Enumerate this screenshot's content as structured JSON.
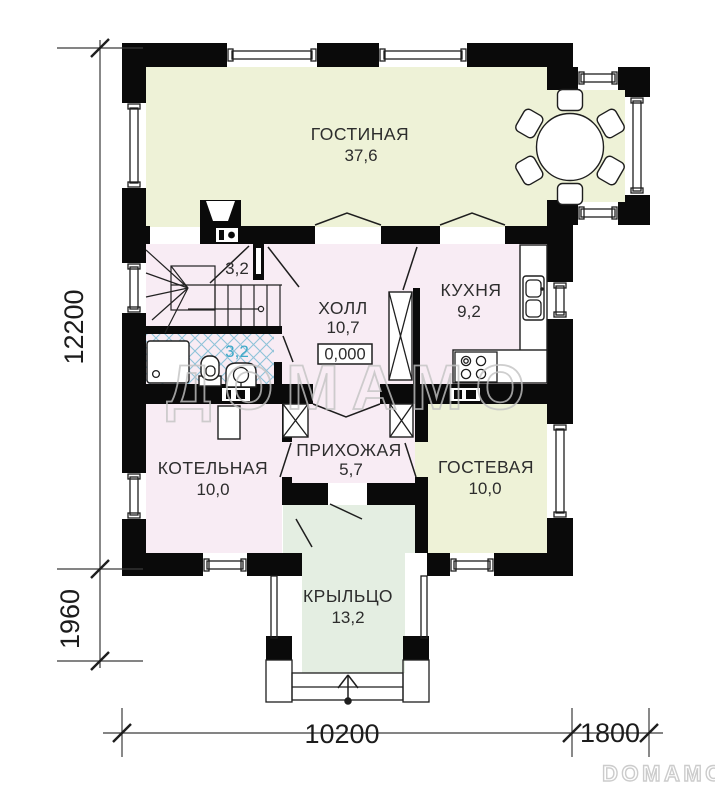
{
  "rooms": {
    "living": {
      "name": "ГОСТИНАЯ",
      "area": "37,6"
    },
    "hall": {
      "name": "ХОЛЛ",
      "area": "10,7"
    },
    "kitchen": {
      "name": "КУХНЯ",
      "area": "9,2"
    },
    "stair": {
      "area": "3,2"
    },
    "bath": {
      "area": "3,2"
    },
    "boiler": {
      "name": "КОТЕЛЬНАЯ",
      "area": "10,0"
    },
    "entry": {
      "name": "ПРИХОЖАЯ",
      "area": "5,7"
    },
    "guest": {
      "name": "ГОСТЕВАЯ",
      "area": "10,0"
    },
    "porch": {
      "name": "КРЫЛЬЦО",
      "area": "13,2"
    }
  },
  "elevation_mark": "0,000",
  "dimensions": {
    "left_main": "12200",
    "left_porch": "1960",
    "bottom_main": "10200",
    "bottom_bay": "1800"
  },
  "watermarks": {
    "center": "ДОМАМО",
    "corner": "DOMAMO"
  },
  "colors": {
    "wall": "#0a0a0a",
    "living_fill": "#eef2d7",
    "guest_fill": "#eef2d7",
    "pink_fill": "#f8ecf4",
    "porch_fill": "#e4eee2",
    "tile_hatch": "#8fc3d9",
    "bath_label": "#3fa9c9",
    "watermark": "#c3c3c3"
  }
}
